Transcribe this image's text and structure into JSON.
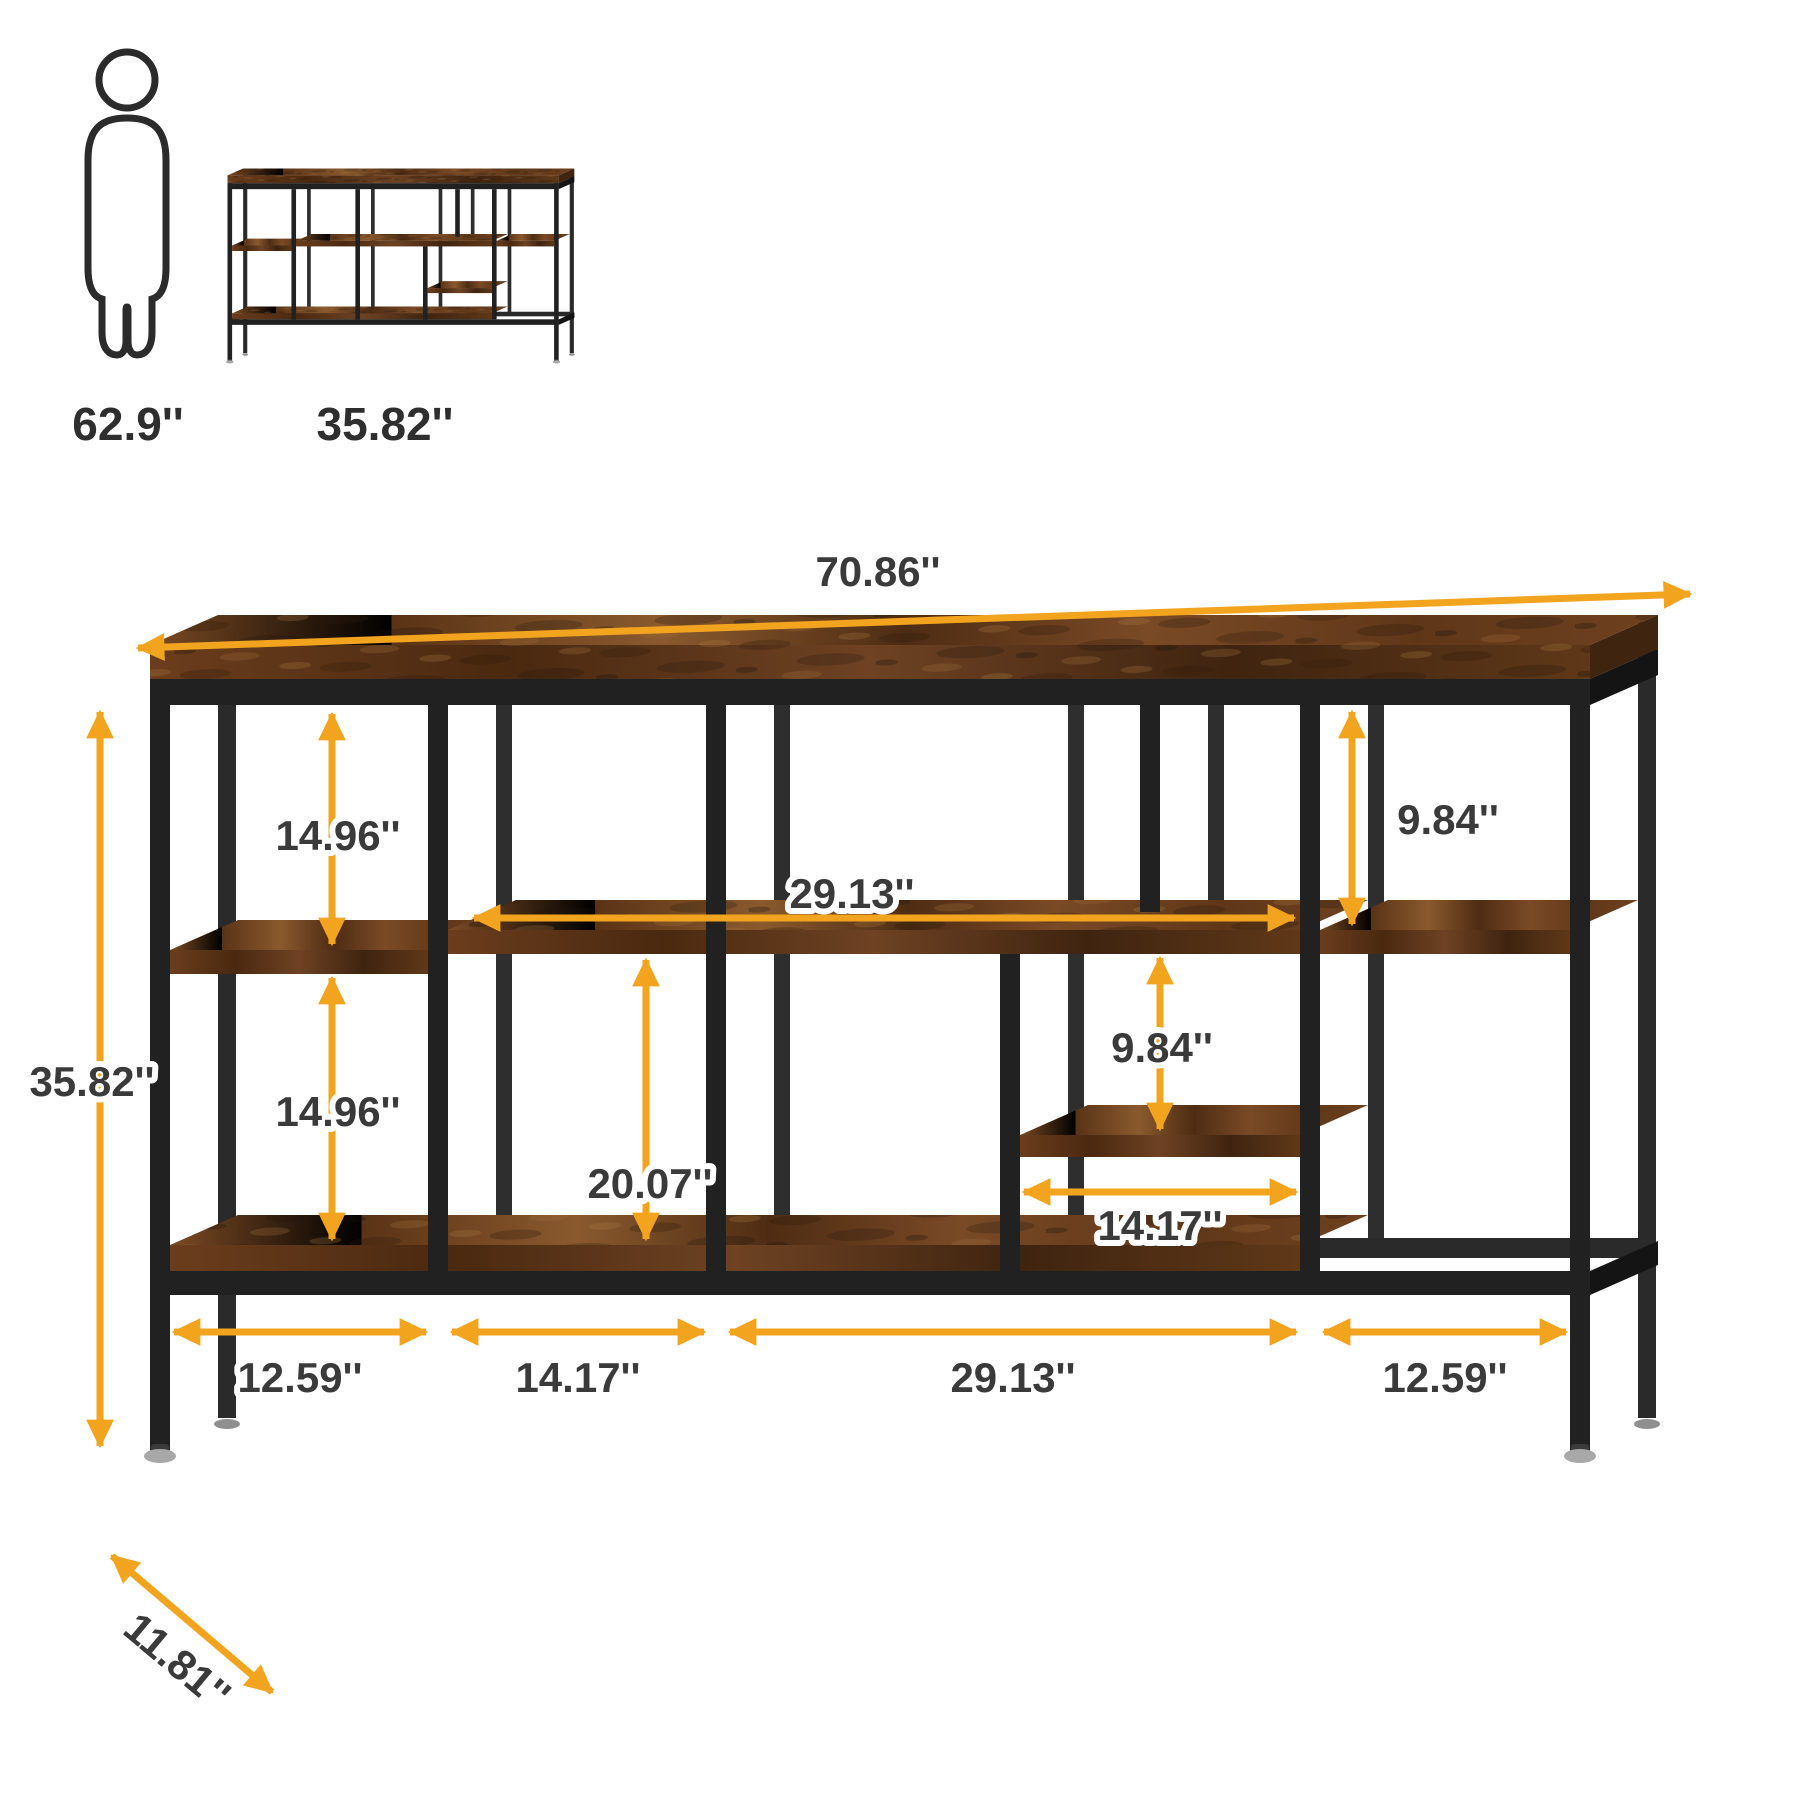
{
  "image_type": "product dimension diagram",
  "product": "industrial TV stand / console table with rustic brown shelves and black metal frame",
  "colors": {
    "accent_arrows": "#F2A41F",
    "dimension_text": "#3a3a3a",
    "metal_frame": "#212121",
    "wood_dark": "#4e2c13",
    "wood_mid": "#6e4124",
    "wood_light": "#8a5a2e",
    "background": "#ffffff"
  },
  "scale_reference": {
    "person_height_label": "62.9''",
    "product_height_label": "35.82''"
  },
  "dimensions": {
    "total_width": {
      "label": "70.86''"
    },
    "total_height": {
      "label": "35.82''"
    },
    "depth": {
      "label": "11.81''"
    },
    "top_to_left_shelf": {
      "label": "14.96''"
    },
    "left_shelf_to_bottom_shelf": {
      "label": "14.96''"
    },
    "upper_middle_shelf_width": {
      "label": "29.13''"
    },
    "top_to_upper_middle_shelf": {
      "label": "9.84''"
    },
    "upper_shelf_to_middle_shelf": {
      "label": "9.84''"
    },
    "upper_shelf_to_bottom_shelf": {
      "label": "20.07''"
    },
    "middle_right_shelf_width": {
      "label": "14.17''"
    },
    "bottom_section_left": {
      "label": "12.59''"
    },
    "bottom_section_mid_left": {
      "label": "14.17''"
    },
    "bottom_section_mid_right": {
      "label": "29.13''"
    },
    "bottom_section_right": {
      "label": "12.59''"
    }
  }
}
